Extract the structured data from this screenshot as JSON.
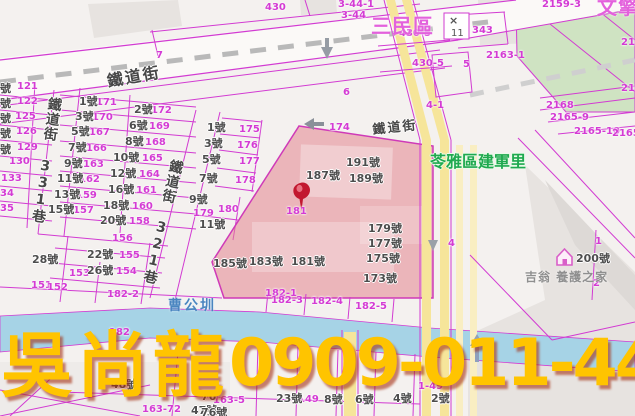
{
  "overlay": {
    "agent_name": "吳尚龍",
    "phone": "0909-011-448"
  },
  "map": {
    "colors": {
      "boundary_line": "#d23bd2",
      "highlight_parcel_fill": "#e4848e",
      "canal_fill": "#a6d3e6",
      "road_yellow": "#f6e59a",
      "green_area": "#cfe3c2",
      "watermark_text": "#ffc400",
      "district_text": "#e361dc",
      "village_text": "#1fa94f",
      "canal_text": "#4a85c0",
      "pin_red": "#c2182f"
    },
    "icons": [
      "map-pin-icon",
      "house-icon",
      "x-marker-icon",
      "down-arrow-icon",
      "left-arrow-icon",
      "up-arrow-icon"
    ],
    "marker_box": {
      "mark": "×",
      "num": "11"
    },
    "labels": [
      {
        "k": "lot",
        "t": "430",
        "x": 265,
        "y": 3
      },
      {
        "k": "lot",
        "t": "3-44-1",
        "x": 338,
        "y": 0
      },
      {
        "k": "lot",
        "t": "3-44",
        "x": 341,
        "y": 11
      },
      {
        "k": "lot",
        "t": "2159-3",
        "x": 542,
        "y": 0
      },
      {
        "k": "lot",
        "t": "430-5",
        "x": 399,
        "y": 29
      },
      {
        "k": "lot",
        "t": "343",
        "x": 472,
        "y": 26
      },
      {
        "k": "lot",
        "t": "430-5",
        "x": 412,
        "y": 59
      },
      {
        "k": "lot",
        "t": "5",
        "x": 463,
        "y": 60
      },
      {
        "k": "lot",
        "t": "2163-1",
        "x": 486,
        "y": 51
      },
      {
        "k": "lot",
        "t": "216",
        "x": 621,
        "y": 38
      },
      {
        "k": "lot",
        "t": "216",
        "x": 621,
        "y": 84
      },
      {
        "k": "lot",
        "t": "2168",
        "x": 546,
        "y": 101
      },
      {
        "k": "lot",
        "t": "2165-9",
        "x": 550,
        "y": 113
      },
      {
        "k": "lot",
        "t": "2165-10",
        "x": 574,
        "y": 127
      },
      {
        "k": "lot",
        "t": "2165",
        "x": 612,
        "y": 129
      },
      {
        "k": "lot",
        "t": "7",
        "x": 156,
        "y": 51
      },
      {
        "k": "lot",
        "t": "6",
        "x": 343,
        "y": 88
      },
      {
        "k": "lot",
        "t": "4-1",
        "x": 426,
        "y": 101
      },
      {
        "k": "lot",
        "t": "174",
        "x": 329,
        "y": 123
      },
      {
        "k": "lot",
        "t": "121",
        "x": 17,
        "y": 82
      },
      {
        "k": "lot",
        "t": "122",
        "x": 17,
        "y": 97
      },
      {
        "k": "lot",
        "t": "125",
        "x": 15,
        "y": 112
      },
      {
        "k": "lot",
        "t": "126",
        "x": 16,
        "y": 127
      },
      {
        "k": "lot",
        "t": "129",
        "x": 17,
        "y": 143
      },
      {
        "k": "lot",
        "t": "130",
        "x": 9,
        "y": 157
      },
      {
        "k": "lot",
        "t": "133",
        "x": 1,
        "y": 174
      },
      {
        "k": "lot",
        "t": "34",
        "x": 0,
        "y": 189
      },
      {
        "k": "lot",
        "t": "35",
        "x": 0,
        "y": 204
      },
      {
        "k": "lot",
        "t": "171",
        "x": 96,
        "y": 98
      },
      {
        "k": "lot",
        "t": "172",
        "x": 151,
        "y": 106
      },
      {
        "k": "lot",
        "t": "170",
        "x": 92,
        "y": 113
      },
      {
        "k": "lot",
        "t": "169",
        "x": 149,
        "y": 122
      },
      {
        "k": "lot",
        "t": "167",
        "x": 89,
        "y": 128
      },
      {
        "k": "lot",
        "t": "168",
        "x": 145,
        "y": 138
      },
      {
        "k": "lot",
        "t": "166",
        "x": 86,
        "y": 144
      },
      {
        "k": "lot",
        "t": "165",
        "x": 142,
        "y": 154
      },
      {
        "k": "lot",
        "t": "163",
        "x": 83,
        "y": 160
      },
      {
        "k": "lot",
        "t": "164",
        "x": 139,
        "y": 170
      },
      {
        "k": "lot",
        "t": "162",
        "x": 79,
        "y": 175
      },
      {
        "k": "lot",
        "t": "161",
        "x": 136,
        "y": 186
      },
      {
        "k": "lot",
        "t": "159",
        "x": 76,
        "y": 191
      },
      {
        "k": "lot",
        "t": "160",
        "x": 132,
        "y": 202
      },
      {
        "k": "lot",
        "t": "157",
        "x": 73,
        "y": 206
      },
      {
        "k": "lot",
        "t": "158",
        "x": 129,
        "y": 217
      },
      {
        "k": "lot",
        "t": "156",
        "x": 112,
        "y": 234
      },
      {
        "k": "lot",
        "t": "155",
        "x": 119,
        "y": 251
      },
      {
        "k": "lot",
        "t": "154",
        "x": 116,
        "y": 267
      },
      {
        "k": "lot",
        "t": "153",
        "x": 69,
        "y": 269
      },
      {
        "k": "lot",
        "t": "151",
        "x": 31,
        "y": 281
      },
      {
        "k": "lot",
        "t": "152",
        "x": 47,
        "y": 283
      },
      {
        "k": "lot",
        "t": "175",
        "x": 239,
        "y": 125
      },
      {
        "k": "lot",
        "t": "176",
        "x": 237,
        "y": 141
      },
      {
        "k": "lot",
        "t": "177",
        "x": 239,
        "y": 157
      },
      {
        "k": "lot",
        "t": "178",
        "x": 235,
        "y": 176
      },
      {
        "k": "lot",
        "t": "179",
        "x": 193,
        "y": 209
      },
      {
        "k": "lot",
        "t": "180",
        "x": 218,
        "y": 205
      },
      {
        "k": "lot",
        "t": "181",
        "x": 286,
        "y": 207
      },
      {
        "k": "lot",
        "t": "182-1",
        "x": 265,
        "y": 289
      },
      {
        "k": "lot",
        "t": "182-2",
        "x": 107,
        "y": 290
      },
      {
        "k": "lot",
        "t": "182-3",
        "x": 271,
        "y": 296
      },
      {
        "k": "lot",
        "t": "182-4",
        "x": 311,
        "y": 297
      },
      {
        "k": "lot",
        "t": "182-5",
        "x": 355,
        "y": 302
      },
      {
        "k": "lot",
        "t": "182",
        "x": 109,
        "y": 328
      },
      {
        "k": "lot",
        "t": "149",
        "x": 298,
        "y": 395
      },
      {
        "k": "lot",
        "t": "1-49",
        "x": 418,
        "y": 382
      },
      {
        "k": "lot",
        "t": "163-5",
        "x": 213,
        "y": 396
      },
      {
        "k": "lot",
        "t": "163-72",
        "x": 142,
        "y": 405
      },
      {
        "k": "lot",
        "t": "2",
        "x": 593,
        "y": 279
      },
      {
        "k": "lot",
        "t": "1",
        "x": 595,
        "y": 237
      },
      {
        "k": "lot",
        "t": "4",
        "x": 448,
        "y": 239
      },
      {
        "k": "house",
        "t": "號",
        "x": 0,
        "y": 83
      },
      {
        "k": "house",
        "t": "號",
        "x": 0,
        "y": 98
      },
      {
        "k": "house",
        "t": "號",
        "x": 0,
        "y": 113
      },
      {
        "k": "house",
        "t": "號",
        "x": 0,
        "y": 128
      },
      {
        "k": "house",
        "t": "號",
        "x": 0,
        "y": 144
      },
      {
        "k": "house",
        "t": "1號",
        "x": 79,
        "y": 96
      },
      {
        "k": "house",
        "t": "2號",
        "x": 134,
        "y": 104
      },
      {
        "k": "house",
        "t": "3號",
        "x": 75,
        "y": 111
      },
      {
        "k": "house",
        "t": "6號",
        "x": 129,
        "y": 120
      },
      {
        "k": "house",
        "t": "5號",
        "x": 71,
        "y": 126
      },
      {
        "k": "house",
        "t": "8號",
        "x": 125,
        "y": 136
      },
      {
        "k": "house",
        "t": "7號",
        "x": 68,
        "y": 142
      },
      {
        "k": "house",
        "t": "10號",
        "x": 113,
        "y": 152
      },
      {
        "k": "house",
        "t": "9號",
        "x": 64,
        "y": 158
      },
      {
        "k": "house",
        "t": "12號",
        "x": 110,
        "y": 168
      },
      {
        "k": "house",
        "t": "11號",
        "x": 57,
        "y": 173
      },
      {
        "k": "house",
        "t": "16號",
        "x": 108,
        "y": 184
      },
      {
        "k": "house",
        "t": "13號",
        "x": 54,
        "y": 189
      },
      {
        "k": "house",
        "t": "18號",
        "x": 103,
        "y": 200
      },
      {
        "k": "house",
        "t": "15號",
        "x": 48,
        "y": 204
      },
      {
        "k": "house",
        "t": "20號",
        "x": 100,
        "y": 215
      },
      {
        "k": "house",
        "t": "22號",
        "x": 87,
        "y": 249
      },
      {
        "k": "house",
        "t": "26號",
        "x": 87,
        "y": 265
      },
      {
        "k": "house",
        "t": "28號",
        "x": 32,
        "y": 254
      },
      {
        "k": "house",
        "t": "1號",
        "x": 207,
        "y": 122
      },
      {
        "k": "house",
        "t": "3號",
        "x": 204,
        "y": 138
      },
      {
        "k": "house",
        "t": "5號",
        "x": 202,
        "y": 154
      },
      {
        "k": "house",
        "t": "7號",
        "x": 199,
        "y": 173
      },
      {
        "k": "house",
        "t": "9號",
        "x": 189,
        "y": 194
      },
      {
        "k": "house",
        "t": "11號",
        "x": 199,
        "y": 219
      },
      {
        "k": "house",
        "t": "187號",
        "x": 306,
        "y": 170
      },
      {
        "k": "house",
        "t": "191號",
        "x": 346,
        "y": 157
      },
      {
        "k": "house",
        "t": "189號",
        "x": 349,
        "y": 173
      },
      {
        "k": "house",
        "t": "179號",
        "x": 368,
        "y": 223
      },
      {
        "k": "house",
        "t": "177號",
        "x": 368,
        "y": 238
      },
      {
        "k": "house",
        "t": "175號",
        "x": 366,
        "y": 253
      },
      {
        "k": "house",
        "t": "173號",
        "x": 363,
        "y": 273
      },
      {
        "k": "house",
        "t": "185號",
        "x": 213,
        "y": 258
      },
      {
        "k": "house",
        "t": "183號",
        "x": 249,
        "y": 256
      },
      {
        "k": "house",
        "t": "181號",
        "x": 291,
        "y": 256
      },
      {
        "k": "house",
        "t": "200號",
        "x": 576,
        "y": 253
      },
      {
        "k": "house",
        "t": "48號",
        "x": 111,
        "y": 379
      },
      {
        "k": "house",
        "t": "47號",
        "x": 191,
        "y": 405
      },
      {
        "k": "house",
        "t": "76",
        "x": 201,
        "y": 391
      },
      {
        "k": "house",
        "t": "76號",
        "x": 201,
        "y": 407
      },
      {
        "k": "house",
        "t": "23號",
        "x": 276,
        "y": 393
      },
      {
        "k": "house",
        "t": "8號",
        "x": 324,
        "y": 394
      },
      {
        "k": "house",
        "t": "6號",
        "x": 355,
        "y": 394
      },
      {
        "k": "house",
        "t": "4號",
        "x": 393,
        "y": 393
      },
      {
        "k": "house",
        "t": "2號",
        "x": 431,
        "y": 393
      },
      {
        "k": "street",
        "t": "鐵道街",
        "x": 106,
        "y": 74,
        "r": -10,
        "s": 16
      },
      {
        "k": "street",
        "t": "鐵道街",
        "x": 372,
        "y": 124,
        "r": -6,
        "s": 13
      },
      {
        "k": "vstreet",
        "t": "鐵道街 331巷",
        "x": 48,
        "y": 96,
        "r": 8
      },
      {
        "k": "vstreet",
        "t": "鐵道街 321巷",
        "x": 170,
        "y": 158,
        "r": 13
      },
      {
        "k": "district",
        "t": "三民區",
        "x": 371,
        "y": 16
      },
      {
        "k": "district",
        "t": "文擎",
        "x": 597,
        "y": -3
      },
      {
        "k": "village",
        "t": "苓雅區建軍里",
        "x": 430,
        "y": 154
      },
      {
        "k": "canal",
        "t": "曹公圳",
        "x": 168,
        "y": 299
      },
      {
        "k": "poi",
        "t": "吉翁 養護之家",
        "x": 525,
        "y": 271
      }
    ]
  }
}
